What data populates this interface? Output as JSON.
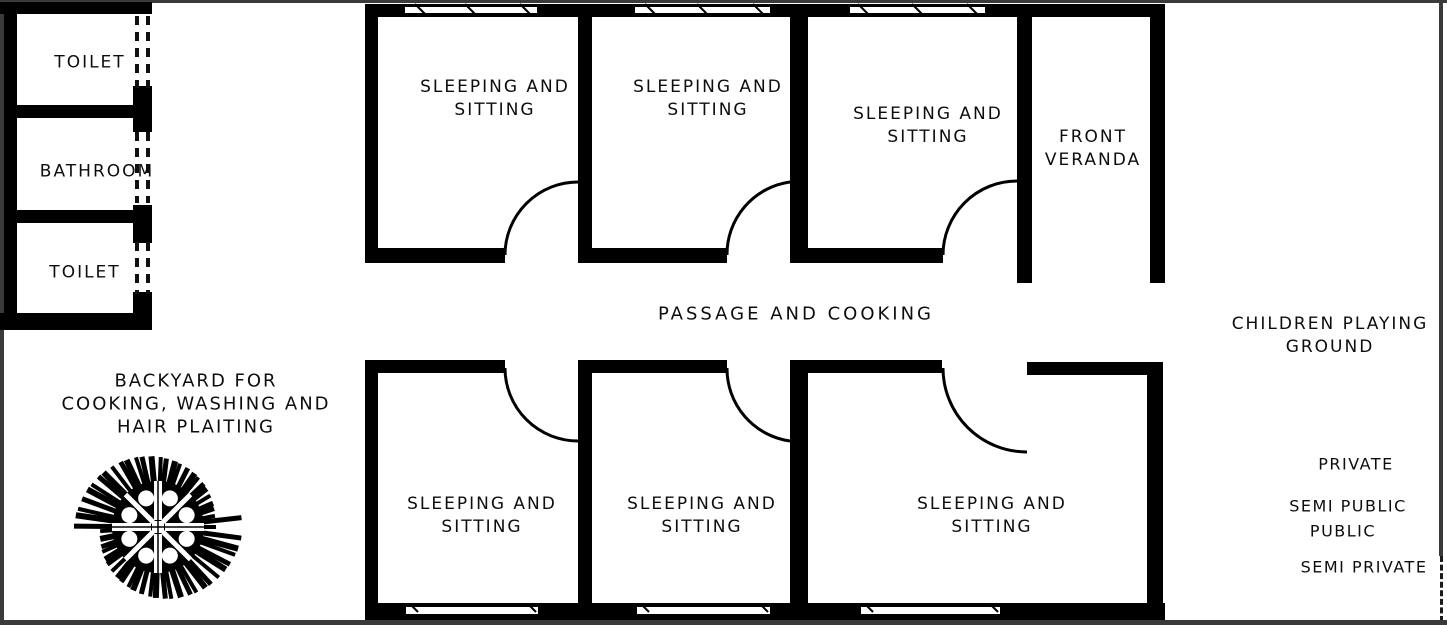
{
  "rooms": {
    "toilet_top": "TOILET",
    "bathroom": "BATHROOM",
    "toilet_bottom": "TOILET",
    "sleeping": {
      "line1": "SLEEPING AND",
      "line2": "SITTING"
    },
    "veranda": {
      "line1": "FRONT",
      "line2": "VERANDA"
    },
    "passage": "PASSAGE AND COOKING"
  },
  "outdoor": {
    "children": {
      "line1": "CHILDREN PLAYING",
      "line2": "GROUND"
    },
    "backyard": {
      "line1": "BACKYARD FOR",
      "line2": "COOKING, WASHING AND",
      "line3": "HAIR PLAITING"
    }
  },
  "zones": {
    "private": "PRIVATE",
    "semi_public": "SEMI PUBLIC",
    "public": "PUBLIC",
    "semi_private": "SEMI PRIVATE"
  },
  "colors": {
    "wall": "#000000",
    "background": "#ffffff",
    "text": "#0d0d0d",
    "border": "#3a3a3a"
  }
}
